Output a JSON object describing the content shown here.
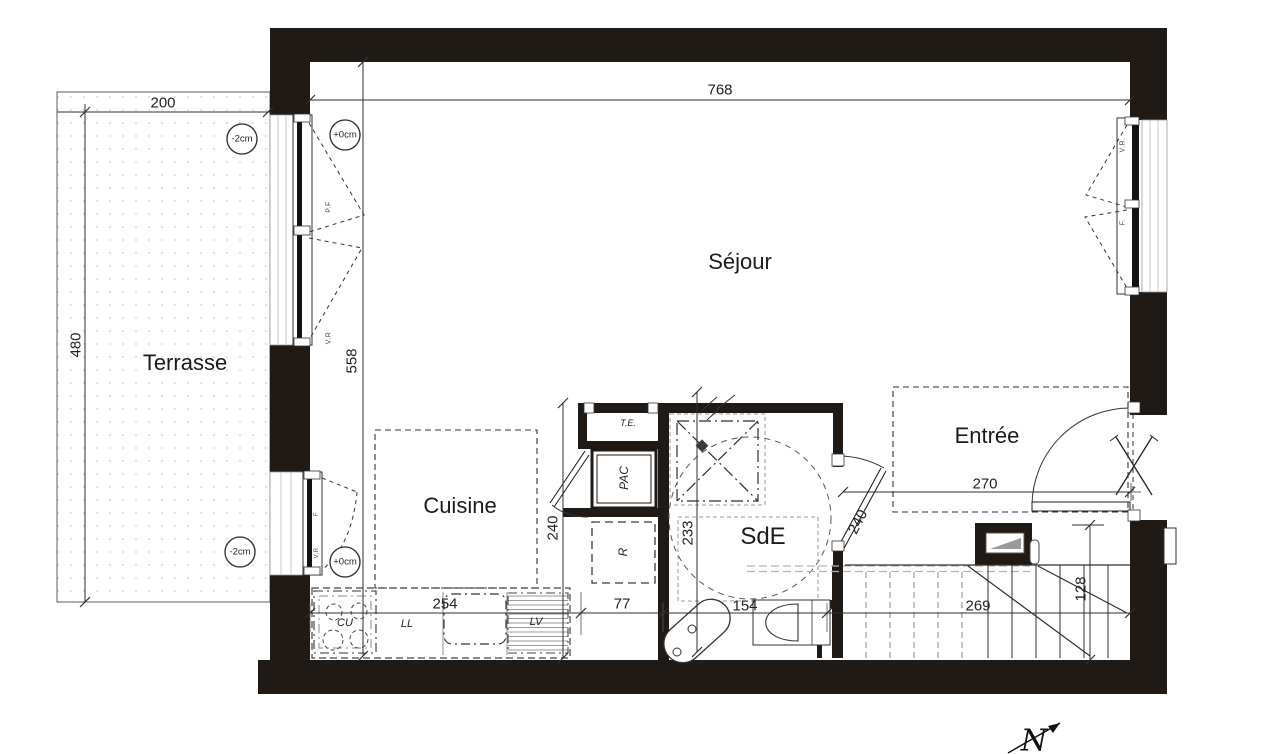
{
  "plan": {
    "title": "floor-plan",
    "rooms": {
      "terrasse": "Terrasse",
      "sejour": "Séjour",
      "cuisine": "Cuisine",
      "sde": "SdE",
      "entree": "Entrée"
    },
    "equipment": {
      "te": "T.E.",
      "pac": "PAC",
      "r": "R",
      "cu": "CU",
      "ll": "LL",
      "lv": "LV"
    },
    "levels": {
      "sejour_window": "+0cm",
      "cuisine_window": "+0cm",
      "terrasse_top": "-2cm",
      "terrasse_bottom": "-2cm"
    },
    "windows": {
      "left_pf": "P.F",
      "left_vr": "V.R",
      "kitchen_f": "F",
      "kitchen_vr": "V.R",
      "right_vr": "V.R.",
      "right_f": "F."
    },
    "dims": {
      "d768": "768",
      "d200": "200",
      "d480": "480",
      "d558": "558",
      "d254": "254",
      "d77": "77",
      "d154": "154",
      "d269": "269",
      "d128": "128",
      "d233": "233",
      "d240_cuisine": "240",
      "d240_door": "240",
      "d270": "270"
    },
    "compass_north": "N"
  }
}
